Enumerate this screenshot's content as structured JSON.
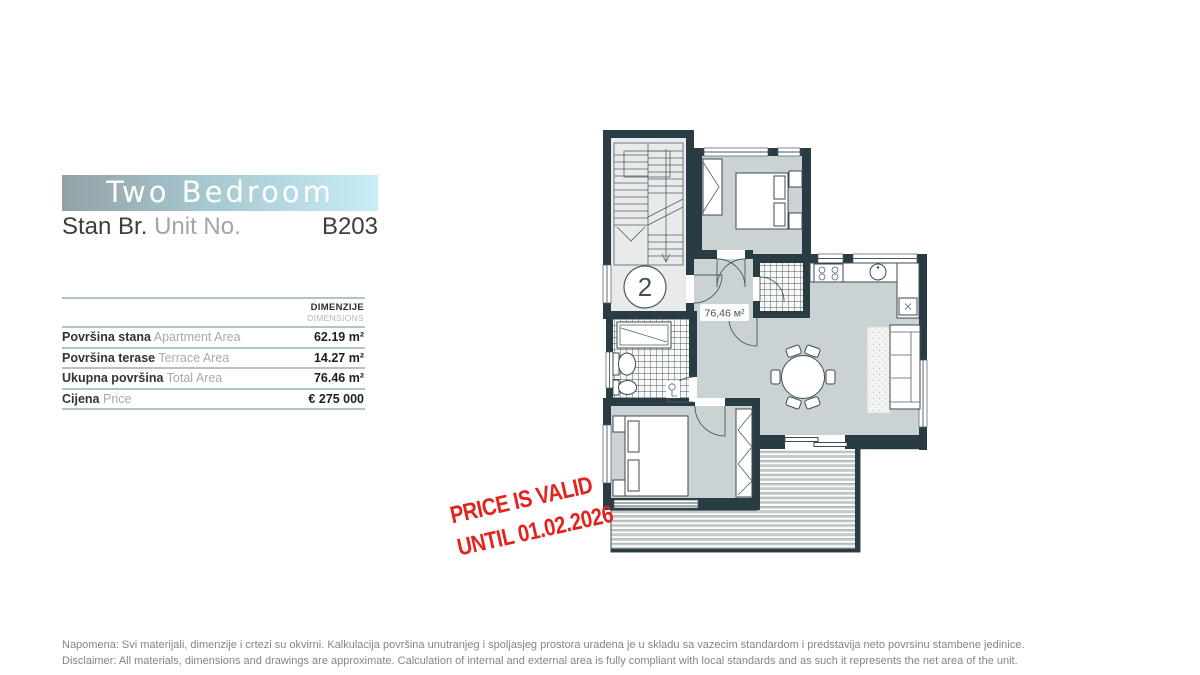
{
  "header": {
    "title": "Two Bedroom",
    "unit_label_primary": "Stan Br.",
    "unit_label_secondary": "Unit No.",
    "unit_number": "B203"
  },
  "table": {
    "header_primary": "DIMENZIJE",
    "header_secondary": "DIMENSIONS",
    "rows": [
      {
        "label_primary": "Površina stana",
        "label_secondary": "Apartment Area",
        "value": "62.19 m²"
      },
      {
        "label_primary": "Površina terase",
        "label_secondary": "Terrace Area",
        "value": "14.27 m²"
      },
      {
        "label_primary": "Ukupna površina",
        "label_secondary": "Total Area",
        "value": "76.46 m²"
      },
      {
        "label_primary": "Cijena",
        "label_secondary": "Price",
        "value": "€ 275 000"
      }
    ]
  },
  "stamp": {
    "line1": "PRICE IS VALID",
    "line2": "UNTIL 01.02.2026",
    "color": "#e3231c"
  },
  "floorplan": {
    "area_label": "76,46 м²",
    "floor_number": "2"
  },
  "footer": {
    "line1": "Napomena: Svi materijali, dimenzije i crtezi su okvirni. Kalkulacija površina unutranjeg i spoljasjeg prostora uradena je u skladu sa vazecim standardom i predstavija neto povrsinu stambene jedinice.",
    "line2": "Disclaimer: All materials, dimensions and drawings are approximate. Calculation of internal and external area is fully compliant with local standards and as such it represents the net area of the unit."
  },
  "colors": {
    "wall": "#2a3c43",
    "floor": "#cbd2d4",
    "divider_line": "#aec5cd",
    "banner_left": "#93a2a6",
    "banner_right": "#c9edf5",
    "stamp_red": "#e3231c"
  }
}
